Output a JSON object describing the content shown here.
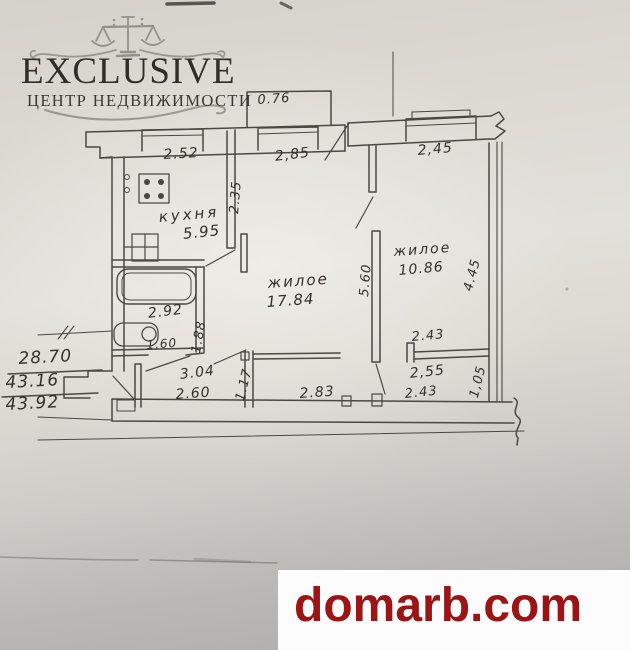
{
  "branding": {
    "title": "EXCLUSIVE",
    "subtitle": "ЦЕНТР НЕДВИЖИМОСТИ",
    "icon": "scales-of-justice",
    "text_color": "#312e2a"
  },
  "watermark": {
    "text": "domarb.com",
    "color": "#9b1516",
    "background": "#fcfcfc"
  },
  "area_summary": {
    "values": [
      "28.70",
      "43.16",
      "43.92"
    ]
  },
  "floor_plan": {
    "type": "apartment-floor-plan",
    "rooms": [
      {
        "name": "кухня",
        "area": "5.95"
      },
      {
        "name": "жилое",
        "area": "17.84"
      },
      {
        "name": "жилое",
        "area": "10.86"
      }
    ],
    "dims": {
      "balcony_width": "0.76",
      "kitchen_window": "2.52",
      "living_window": "2,85",
      "room2_window": "2,45",
      "kitchen_depth": "2.35",
      "rooms_divider_length": "5.60",
      "room2_depth": "4.45",
      "bathroom_width": "2.92",
      "bathroom_depth": "1.88",
      "toilet_width": "1.60",
      "hallway_area": "3.04",
      "hallway_width": "2.60",
      "hallway_depth": "1.17",
      "corridor_width": "2.83",
      "room2_bottom_width": "2.43",
      "closet_width_top": "2,55",
      "closet_width_bottom": "2.43",
      "closet_depth": "1,05"
    }
  },
  "colors": {
    "ink": "#403d38",
    "paper_light": "#e2e0da",
    "paper_dark": "#aeacaa"
  }
}
